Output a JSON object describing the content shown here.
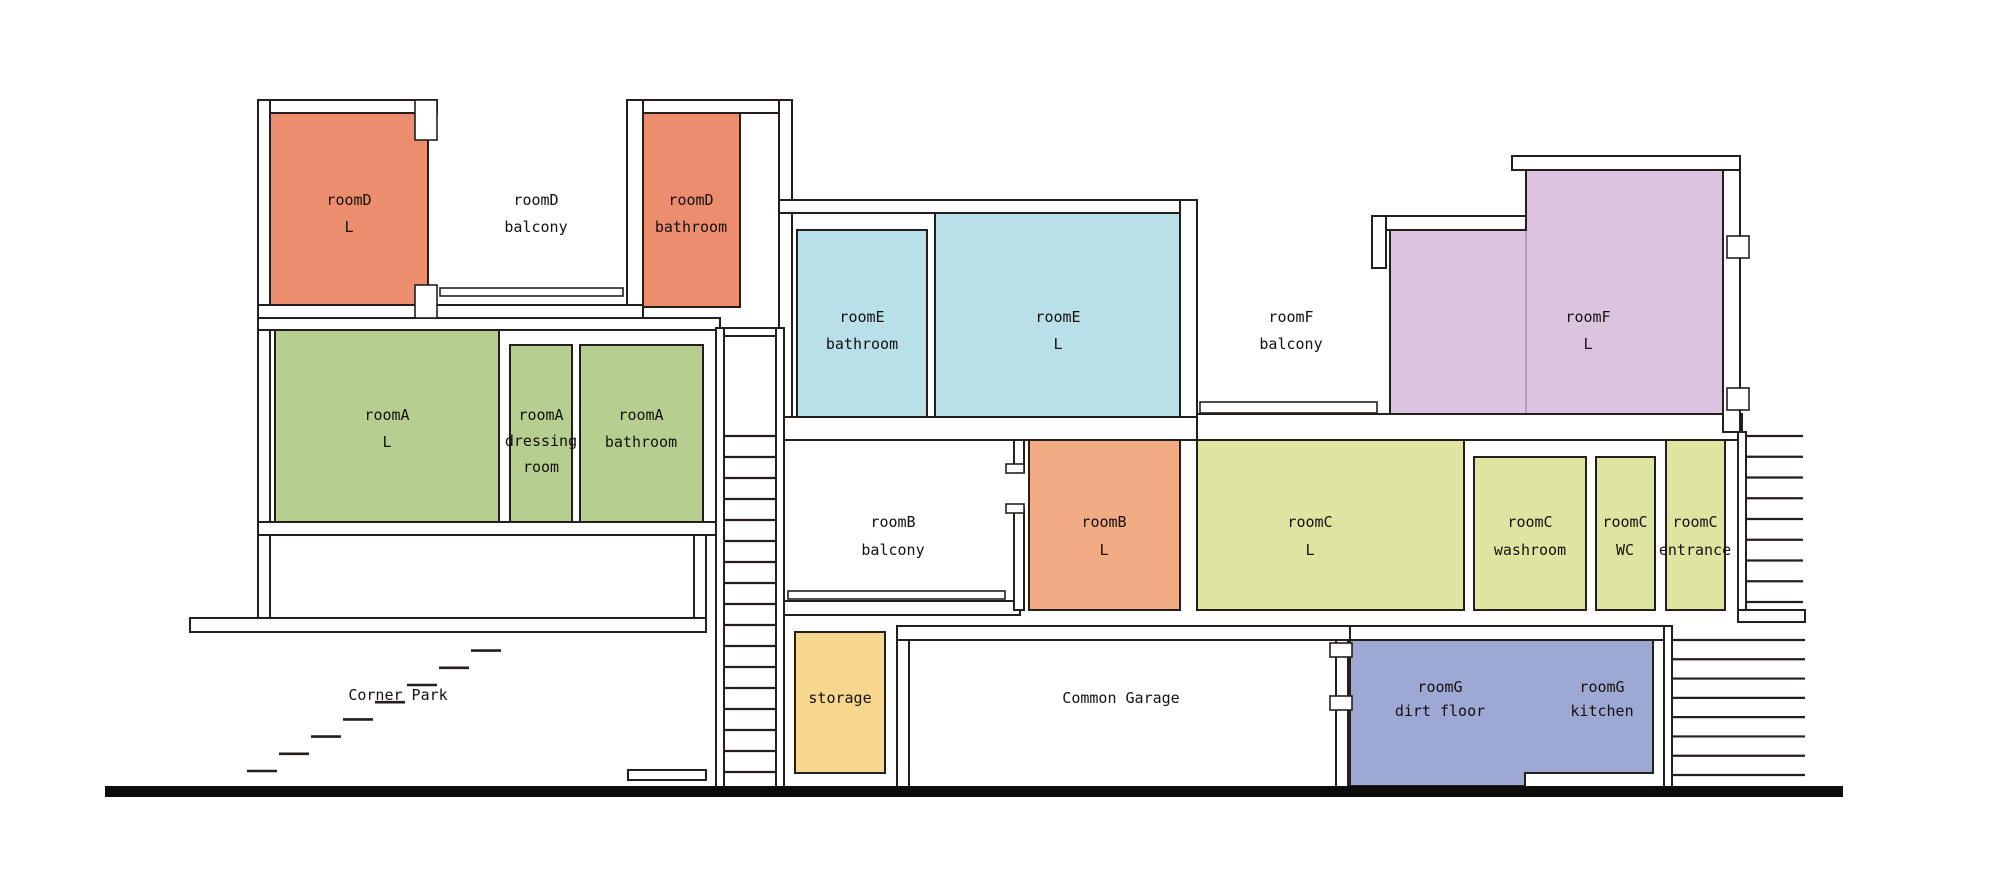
{
  "diagram": {
    "canvas": {
      "w": 2000,
      "h": 876,
      "background": "#ffffff"
    },
    "palette": {
      "stroke": "#241f1c",
      "wall_fill": "#ffffff",
      "ground_fill": "#0d0c0a",
      "text_color": "#14110e",
      "roomD_color": "#EC8D6E",
      "roomB_color": "#F2AC84",
      "roomA_color": "#B6CF90",
      "roomE_color": "#B9DFE9",
      "roomF_color": "#DCC3E0",
      "roomC_color": "#DFE5A1",
      "storage_color": "#F6D78D",
      "roomG_color": "#9EA8D4"
    },
    "rooms": [
      {
        "name": "roomD-L",
        "fill": "#EC8D6E",
        "rect": [
          270,
          113,
          158,
          194
        ]
      },
      {
        "name": "roomD-bathroom",
        "fill": "#EC8D6E",
        "rect": [
          643,
          113,
          97,
          194
        ]
      },
      {
        "name": "roomE-bathroom",
        "fill": "#B9DFE9",
        "rect": [
          797,
          230,
          130,
          187
        ]
      },
      {
        "name": "roomE-L",
        "fill": "#B9DFE9",
        "rect": [
          935,
          213,
          245,
          204
        ]
      },
      {
        "name": "roomF-L",
        "fill": "#DCC3E0",
        "poly": [
          [
            1390,
            230
          ],
          [
            1526,
            230
          ],
          [
            1526,
            170
          ],
          [
            1723,
            170
          ],
          [
            1723,
            417
          ],
          [
            1390,
            417
          ]
        ]
      },
      {
        "name": "roomA-L",
        "fill": "#B6CF90",
        "rect": [
          275,
          329,
          224,
          193
        ]
      },
      {
        "name": "roomA-dressing",
        "fill": "#B6CF90",
        "rect": [
          510,
          345,
          62,
          177
        ]
      },
      {
        "name": "roomA-bathroom",
        "fill": "#B6CF90",
        "rect": [
          580,
          345,
          123,
          177
        ]
      },
      {
        "name": "roomB-L",
        "fill": "#F2AC84",
        "rect": [
          1029,
          440,
          151,
          170
        ]
      },
      {
        "name": "roomC-L",
        "fill": "#DFE5A1",
        "rect": [
          1197,
          440,
          267,
          170
        ]
      },
      {
        "name": "roomC-washroom",
        "fill": "#DFE5A1",
        "rect": [
          1474,
          457,
          112,
          153
        ]
      },
      {
        "name": "roomC-WC",
        "fill": "#DFE5A1",
        "rect": [
          1596,
          457,
          59,
          153
        ]
      },
      {
        "name": "roomC-entrance",
        "fill": "#DFE5A1",
        "rect": [
          1666,
          440,
          59,
          170
        ]
      },
      {
        "name": "storage",
        "fill": "#F6D78D",
        "rect": [
          795,
          632,
          90,
          141
        ]
      },
      {
        "name": "roomG",
        "fill": "#9EA8D4",
        "poly": [
          [
            1350,
            640
          ],
          [
            1653,
            640
          ],
          [
            1653,
            773
          ],
          [
            1525,
            773
          ],
          [
            1525,
            786
          ],
          [
            1350,
            786
          ]
        ]
      }
    ],
    "walls": [
      [
        258,
        100,
        179,
        13
      ],
      [
        258,
        100,
        12,
        532
      ],
      [
        627,
        100,
        165,
        13
      ],
      [
        627,
        100,
        16,
        218
      ],
      [
        258,
        305,
        385,
        13
      ],
      [
        779,
        100,
        13,
        340
      ],
      [
        779,
        200,
        418,
        13
      ],
      [
        1180,
        200,
        17,
        232
      ],
      [
        779,
        417,
        418,
        23
      ],
      [
        1197,
        414,
        545,
        26
      ],
      [
        258,
        318,
        462,
        12
      ],
      [
        258,
        522,
        462,
        13
      ],
      [
        694,
        535,
        12,
        85
      ],
      [
        190,
        618,
        516,
        14
      ],
      [
        628,
        770,
        78,
        10
      ],
      [
        779,
        601,
        241,
        14
      ],
      [
        1014,
        440,
        10,
        32
      ],
      [
        1014,
        508,
        10,
        102
      ],
      [
        897,
        626,
        453,
        14
      ],
      [
        897,
        640,
        12,
        148
      ],
      [
        1336,
        640,
        12,
        148
      ],
      [
        1350,
        626,
        318,
        14
      ],
      [
        1664,
        626,
        8,
        162
      ],
      [
        1738,
        432,
        8,
        178
      ],
      [
        1738,
        610,
        67,
        12
      ],
      [
        1723,
        156,
        17,
        276
      ],
      [
        1512,
        156,
        228,
        14
      ],
      [
        1372,
        216,
        154,
        14
      ],
      [
        1372,
        216,
        14,
        52
      ]
    ],
    "notches": [
      [
        415,
        100,
        22,
        40
      ],
      [
        415,
        285,
        22,
        33
      ],
      [
        1006,
        464,
        18,
        9
      ],
      [
        1006,
        504,
        18,
        9
      ],
      [
        1330,
        643,
        22,
        14
      ],
      [
        1330,
        696,
        22,
        14
      ],
      [
        1727,
        236,
        22,
        22
      ],
      [
        1727,
        388,
        22,
        22
      ]
    ],
    "railings": [
      {
        "name": "roomD-balcony-railing",
        "rect": [
          440,
          288,
          183,
          8
        ]
      },
      {
        "name": "roomF-balcony-railing",
        "rect": [
          1200,
          402,
          177,
          11
        ]
      },
      {
        "name": "roomB-balcony-railing",
        "rect": [
          788,
          591,
          217,
          8
        ]
      }
    ],
    "shaft": {
      "left": [
        716,
        328,
        8,
        460
      ],
      "right": [
        776,
        328,
        8,
        460
      ],
      "cap": [
        716,
        328,
        68,
        8
      ]
    },
    "ladders": [
      {
        "name": "central-staircase",
        "x1": 724,
        "x2": 776,
        "y0": 436,
        "y1": 772,
        "n": 17
      },
      {
        "name": "upper-right-staircase",
        "x1": 1746,
        "x2": 1803,
        "y0": 436,
        "y1": 602,
        "n": 9
      },
      {
        "name": "lower-right-staircase",
        "x1": 1672,
        "x2": 1805,
        "y0": 640,
        "y1": 775,
        "n": 8
      }
    ],
    "step_dashes": {
      "x0": 247,
      "y0": 771,
      "dx": 32,
      "dy": -17.2,
      "n": 8,
      "len": 30
    },
    "seam_lines": [
      [
        1526,
        231,
        1526,
        416,
        "#ab90b2",
        1.5
      ]
    ],
    "ground": [
      105,
      786,
      1738,
      11
    ],
    "labels": [
      {
        "name": "roomD-L-label",
        "lines": [
          "roomD",
          "L"
        ],
        "x": 349,
        "ys": [
          205,
          232
        ]
      },
      {
        "name": "roomD-balcony-label",
        "lines": [
          "roomD",
          "balcony"
        ],
        "x": 536,
        "ys": [
          205,
          232
        ]
      },
      {
        "name": "roomD-bathroom-label",
        "lines": [
          "roomD",
          "bathroom"
        ],
        "x": 691,
        "ys": [
          205,
          232
        ]
      },
      {
        "name": "roomE-bathroom-label",
        "lines": [
          "roomE",
          "bathroom"
        ],
        "x": 862,
        "ys": [
          322,
          349
        ]
      },
      {
        "name": "roomE-L-label",
        "lines": [
          "roomE",
          "L"
        ],
        "x": 1058,
        "ys": [
          322,
          349
        ]
      },
      {
        "name": "roomF-balcony-label",
        "lines": [
          "roomF",
          "balcony"
        ],
        "x": 1291,
        "ys": [
          322,
          349
        ]
      },
      {
        "name": "roomF-L-label",
        "lines": [
          "roomF",
          "L"
        ],
        "x": 1588,
        "ys": [
          322,
          349
        ]
      },
      {
        "name": "roomA-L-label",
        "lines": [
          "roomA",
          "L"
        ],
        "x": 387,
        "ys": [
          420,
          447
        ]
      },
      {
        "name": "roomA-dressing-label",
        "lines": [
          "roomA",
          "dressing",
          "room"
        ],
        "x": 541,
        "ys": [
          420,
          446,
          472
        ]
      },
      {
        "name": "roomA-bathroom-label",
        "lines": [
          "roomA",
          "bathroom"
        ],
        "x": 641,
        "ys": [
          420,
          447
        ]
      },
      {
        "name": "roomB-balcony-label",
        "lines": [
          "roomB",
          "balcony"
        ],
        "x": 893,
        "ys": [
          527,
          555
        ]
      },
      {
        "name": "roomB-L-label",
        "lines": [
          "roomB",
          "L"
        ],
        "x": 1104,
        "ys": [
          527,
          555
        ]
      },
      {
        "name": "roomC-L-label",
        "lines": [
          "roomC",
          "L"
        ],
        "x": 1310,
        "ys": [
          527,
          555
        ]
      },
      {
        "name": "roomC-washroom-label",
        "lines": [
          "roomC",
          "washroom"
        ],
        "x": 1530,
        "ys": [
          527,
          555
        ]
      },
      {
        "name": "roomC-WC-label",
        "lines": [
          "roomC",
          "WC"
        ],
        "x": 1625,
        "ys": [
          527,
          555
        ]
      },
      {
        "name": "roomC-entrance-label",
        "lines": [
          "roomC",
          "entrance"
        ],
        "x": 1695,
        "ys": [
          527,
          555
        ]
      },
      {
        "name": "corner-park-label",
        "lines": [
          "Corner Park"
        ],
        "x": 398,
        "ys": [
          700
        ]
      },
      {
        "name": "storage-label",
        "lines": [
          "storage"
        ],
        "x": 840,
        "ys": [
          703
        ]
      },
      {
        "name": "common-garage-label",
        "lines": [
          "Common Garage"
        ],
        "x": 1121,
        "ys": [
          703
        ]
      },
      {
        "name": "roomG-dirt-floor-label",
        "lines": [
          "roomG",
          "dirt floor"
        ],
        "x": 1440,
        "ys": [
          692,
          716
        ]
      },
      {
        "name": "roomG-kitchen-label",
        "lines": [
          "roomG",
          "kitchen"
        ],
        "x": 1602,
        "ys": [
          692,
          716
        ]
      }
    ]
  }
}
